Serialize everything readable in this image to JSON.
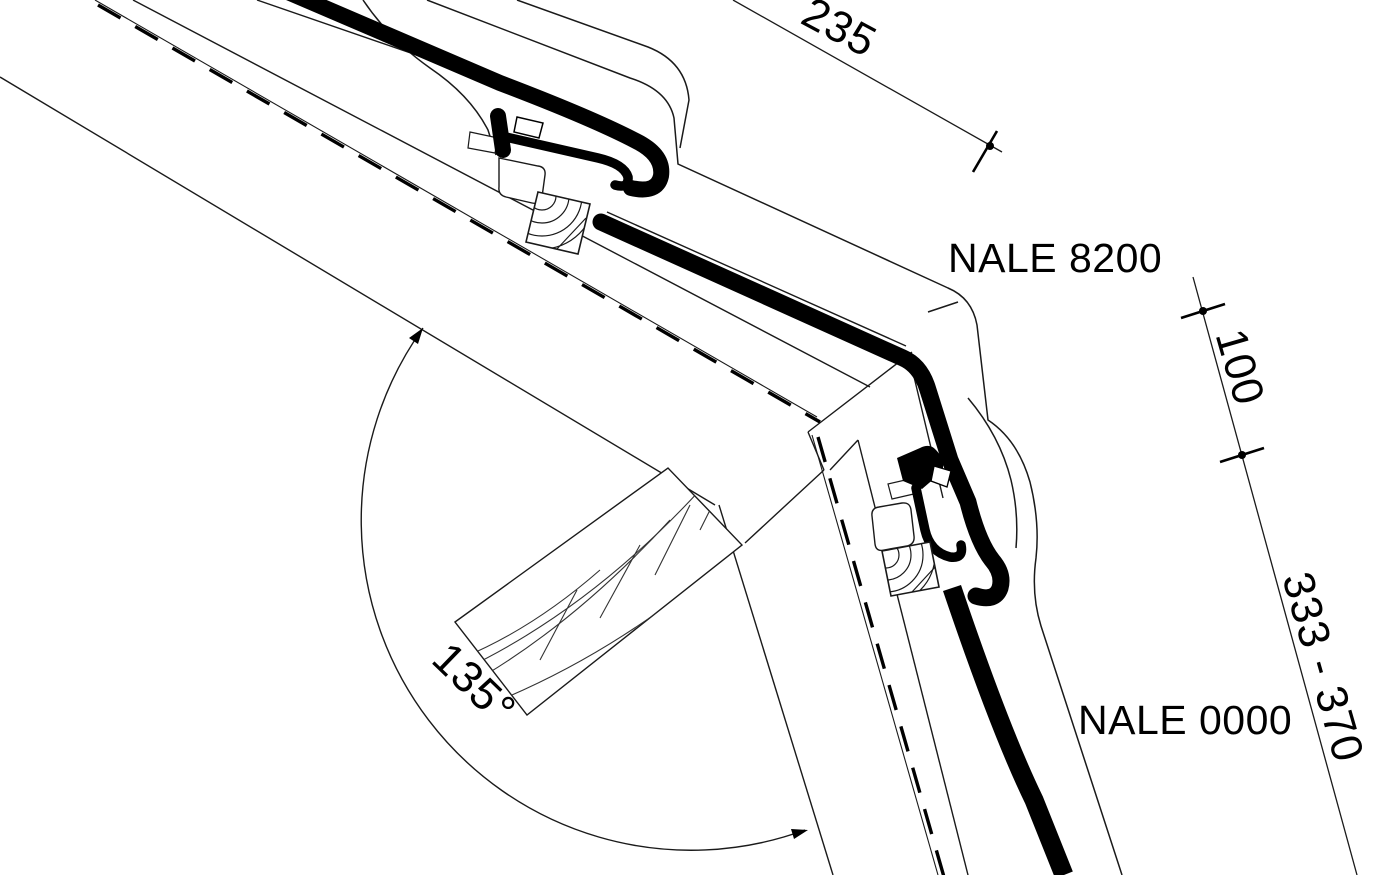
{
  "drawing": {
    "title": "Roof corner flashing detail",
    "type": "technical-detail-drawing",
    "background_color": "#ffffff",
    "ink_color": "#000000",
    "line_color": "#1a1a1a",
    "labels": {
      "product_upper": "NALE 8200",
      "product_lower": "NALE 0000"
    },
    "dimensions": {
      "top_length": "235",
      "side_length_upper": "100",
      "side_length_lower": "333 - 370",
      "corner_angle": "135°"
    },
    "features": [
      "upper slope panel with seam clamp and screw section",
      "lower slope panel with seam clamp and screw section",
      "timber blocking with wood-grain section hatch",
      "135 degree interior angle arc with arrowheads",
      "dimension ticks with dots"
    ]
  }
}
